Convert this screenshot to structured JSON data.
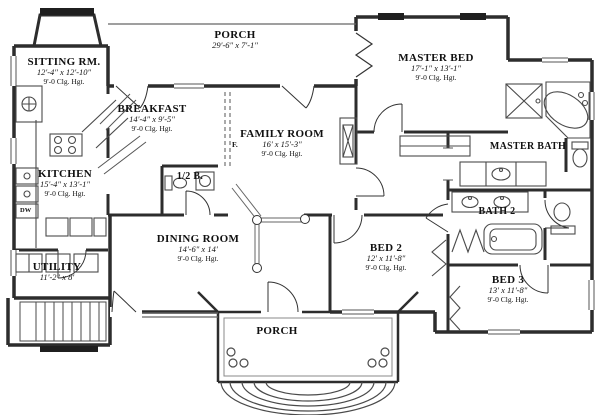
{
  "colors": {
    "background": "#ffffff",
    "wall": "#2d2d2d",
    "fixture": "#4a4a4a",
    "window_fill": "#1f1f1f",
    "text": "#111111"
  },
  "rooms": {
    "sitting": {
      "name": "SITTING RM.",
      "dims": "12'-4\" x 12'-10\"",
      "clg": "9'-0 Clg. Hgt."
    },
    "porch_top": {
      "name": "PORCH",
      "dims": "29'-6\" x 7'-1\""
    },
    "master_bed": {
      "name": "MASTER BED",
      "dims": "17'-1\" x 13'-1\"",
      "clg": "9'-0 Clg. Hgt."
    },
    "breakfast": {
      "name": "BREAKFAST",
      "dims": "14'-4\" x 9'-5\"",
      "clg": "9'-0 Clg. Hgt."
    },
    "family": {
      "name": "FAMILY ROOM",
      "dims": "16' x 15'-3\"",
      "clg": "9'-0 Clg. Hgt."
    },
    "master_bath": {
      "name": "MASTER BATH"
    },
    "kitchen": {
      "name": "KITCHEN",
      "dims": "15'-4\" x 13'-1\"",
      "clg": "9'-0 Clg. Hgt."
    },
    "half_bath": {
      "name": "1/2 B."
    },
    "bath2": {
      "name": "BATH 2"
    },
    "dining": {
      "name": "DINING ROOM",
      "dims": "14'-6\" x 14'",
      "clg": "9'-0 Clg. Hgt."
    },
    "bed2": {
      "name": "BED 2",
      "dims": "12' x 11'-8\"",
      "clg": "9'-0 Clg. Hgt."
    },
    "bed3": {
      "name": "BED 3",
      "dims": "13' x 11'-8\"",
      "clg": "9'-0 Clg. Hgt."
    },
    "utility": {
      "name": "UTILITY",
      "dims": "11'-2\" x 8'"
    },
    "porch_bottom": {
      "name": "PORCH"
    }
  },
  "markers": {
    "dw": "DW",
    "f": "F."
  }
}
